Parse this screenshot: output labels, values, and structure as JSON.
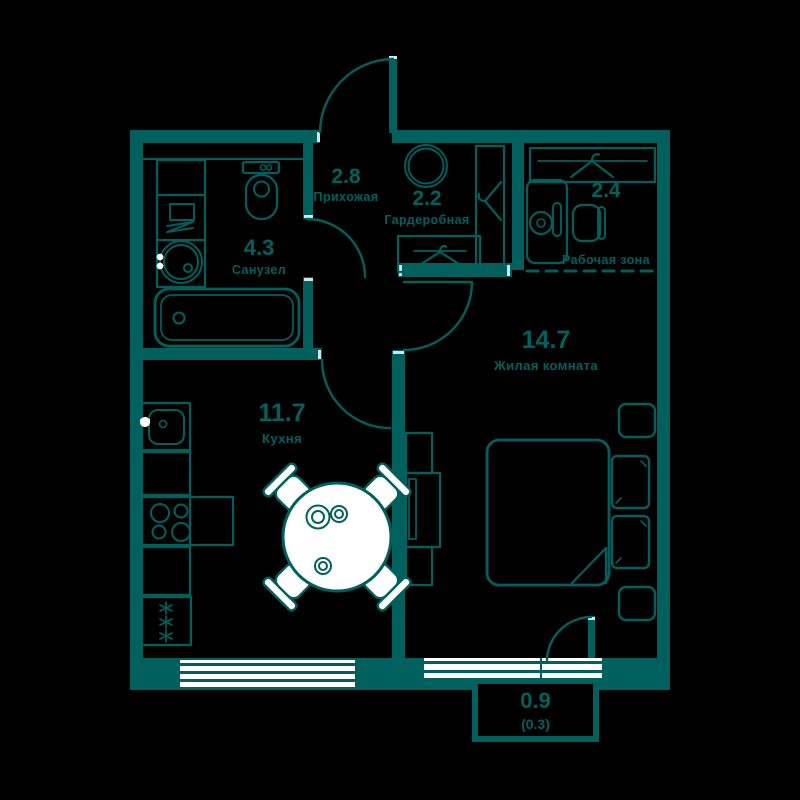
{
  "palette": {
    "background": "#000000",
    "ink": "#00605D",
    "paper": "#FFFFFF"
  },
  "rooms": [
    {
      "key": "hallway",
      "area": "2.8",
      "name": "Прихожая"
    },
    {
      "key": "wardrobe",
      "area": "2.2",
      "name": "Гардеробная"
    },
    {
      "key": "work-zone",
      "area": "2.4",
      "name": "Рабочая зона"
    },
    {
      "key": "bathroom",
      "area": "4.3",
      "name": "Санузел"
    },
    {
      "key": "living-room",
      "area": "14.7",
      "name": "Жилая комната"
    },
    {
      "key": "kitchen",
      "area": "11.7",
      "name": "Кухня"
    },
    {
      "key": "balcony",
      "area": "0.9",
      "area_reduced": "(0.3)"
    }
  ],
  "fixtures": [
    "toilet-icon",
    "washing-machine-icon",
    "round-sink-icon",
    "bathtub-icon",
    "kitchen-sink-icon",
    "stove-icon",
    "fridge-icon",
    "dining-table-icon",
    "chair-icon",
    "bed-icon",
    "pillow-icon",
    "nightstand-icon",
    "tv-console-icon",
    "mirror-circle-icon",
    "hanger-icon",
    "desk-icon",
    "lamp-icon",
    "window-icon",
    "door-arc-icon"
  ]
}
